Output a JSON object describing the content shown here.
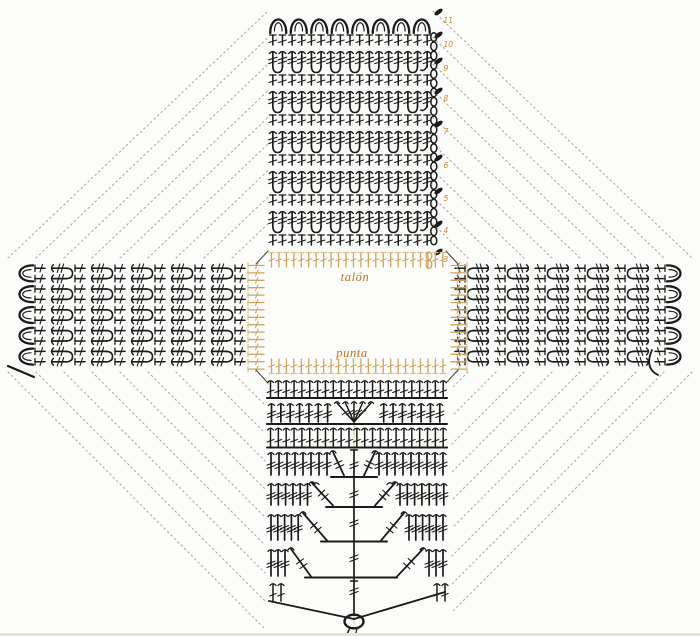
{
  "page": {
    "title": "Diagrama de crochet en cruz (escarpín cuadrado)",
    "background": "#fcfcfa"
  },
  "labels": {
    "heel": "talón",
    "toe": "punta"
  },
  "row_numbers": [
    "11",
    "10",
    "9",
    "8",
    "7",
    "6",
    "5",
    "4",
    "3"
  ],
  "colors": {
    "symbol": "#1b1b1b",
    "tan": "#cda462",
    "tan_light": "#dcc18c",
    "label": "#c0711d",
    "number": "#bf8a3a",
    "dotted": "#a9a9a9",
    "fold": "#d6d093",
    "corner": "#4a4a4a",
    "edge": "#e2e2e0"
  },
  "arms": {
    "top": {
      "scallops": 8,
      "stitch_columns": 17,
      "row_bands": 11,
      "edge_chain_loops": 23,
      "stitch_markers": 9
    },
    "left": {
      "scallops": 5,
      "stitch_rows": 10,
      "row_bands": 11
    },
    "right": {
      "scallops": 5,
      "stitch_rows": 10,
      "row_bands": 11
    },
    "bottom": {
      "stitch_columns": 23,
      "decrease_tiers": 4,
      "center_fan_stitches": 5
    }
  },
  "join_lines": {
    "per_quadrant": 9,
    "style": "dotted"
  }
}
